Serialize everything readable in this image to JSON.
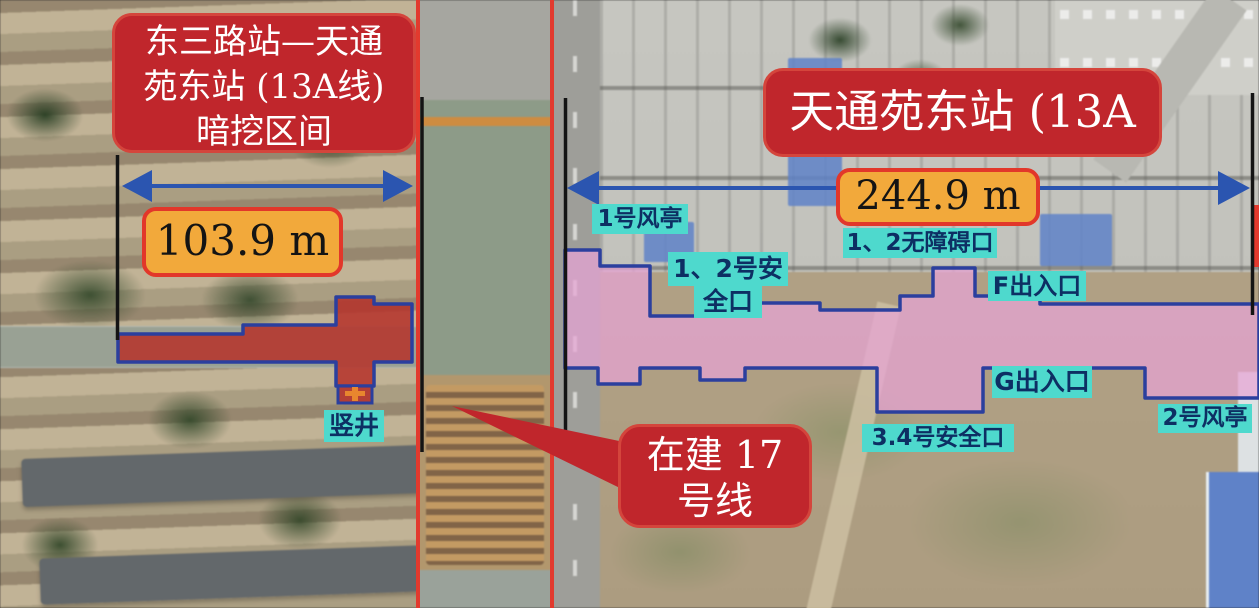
{
  "colors": {
    "callout_red": "#c0262c",
    "measure_fill": "#f2a93b",
    "measure_border": "#e2372a",
    "teal_label_bg": "#4ed9cd",
    "teal_label_text": "#0d2f63",
    "arrow_blue": "#2b55b0",
    "outline_blue": "#2b3f9e",
    "station_pink": "#e7a3d6",
    "tunnel_red": "#b5342c",
    "corridor_red": "#e23a2e",
    "measure_line_black": "#141414"
  },
  "callouts": {
    "tunnel_section": {
      "line1": "东三路站—天通",
      "line2": "苑东站 (13A线)",
      "line3": "暗挖区间"
    },
    "tunnel_length": "103.9 m",
    "station_title": "天通苑东站 (13A线)",
    "station_length": "244.9 m",
    "line17": {
      "line1": "在建 17",
      "line2": "号线"
    }
  },
  "facility_labels": {
    "vent_1": "1号风亭",
    "safety_1_2_line1": "1、2号安",
    "safety_1_2_line2": "全口",
    "barrier_free_1_2": "1、2无障碍口",
    "exit_f": "F出入口",
    "exit_g": "G出入口",
    "safety_3_4": "3.4号安全口",
    "vent_2": "2号风亭",
    "shaft": "竖井"
  }
}
